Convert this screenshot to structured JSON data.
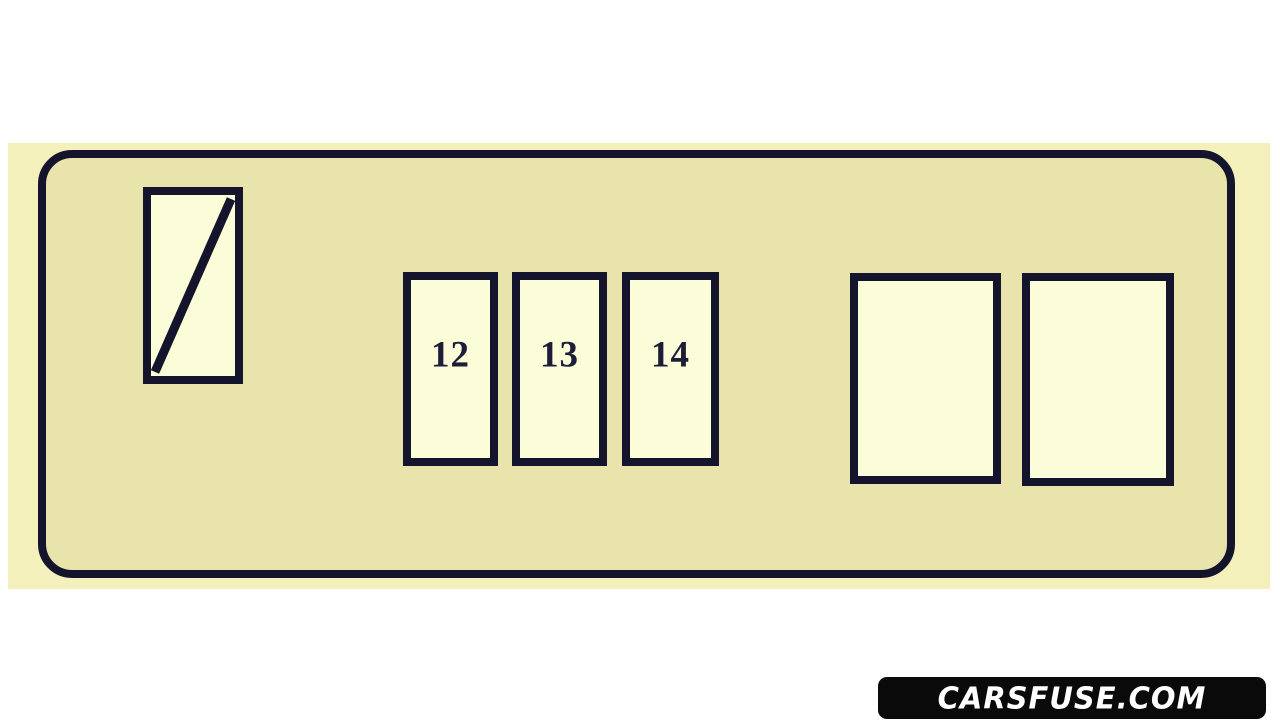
{
  "diagram": {
    "type": "fuse-box",
    "fuses": [
      {
        "name": "diagonal-slot",
        "label": "",
        "style": "diagonal-line"
      },
      {
        "name": "fuse-12",
        "label": "12"
      },
      {
        "name": "fuse-13",
        "label": "13"
      },
      {
        "name": "fuse-14",
        "label": "14"
      },
      {
        "name": "relay-left",
        "label": ""
      },
      {
        "name": "relay-right",
        "label": ""
      }
    ],
    "colors": {
      "scan_background": "#f4f0bb",
      "panel_fill": "#e9e4ab",
      "outline": "#14142c",
      "slot_fill": "#fbfcd8",
      "label_text": "#1d1d3a"
    }
  },
  "watermark": {
    "text": "CARSFUSE.COM",
    "background": "#0a0a0a",
    "text_color": "#ffffff"
  }
}
